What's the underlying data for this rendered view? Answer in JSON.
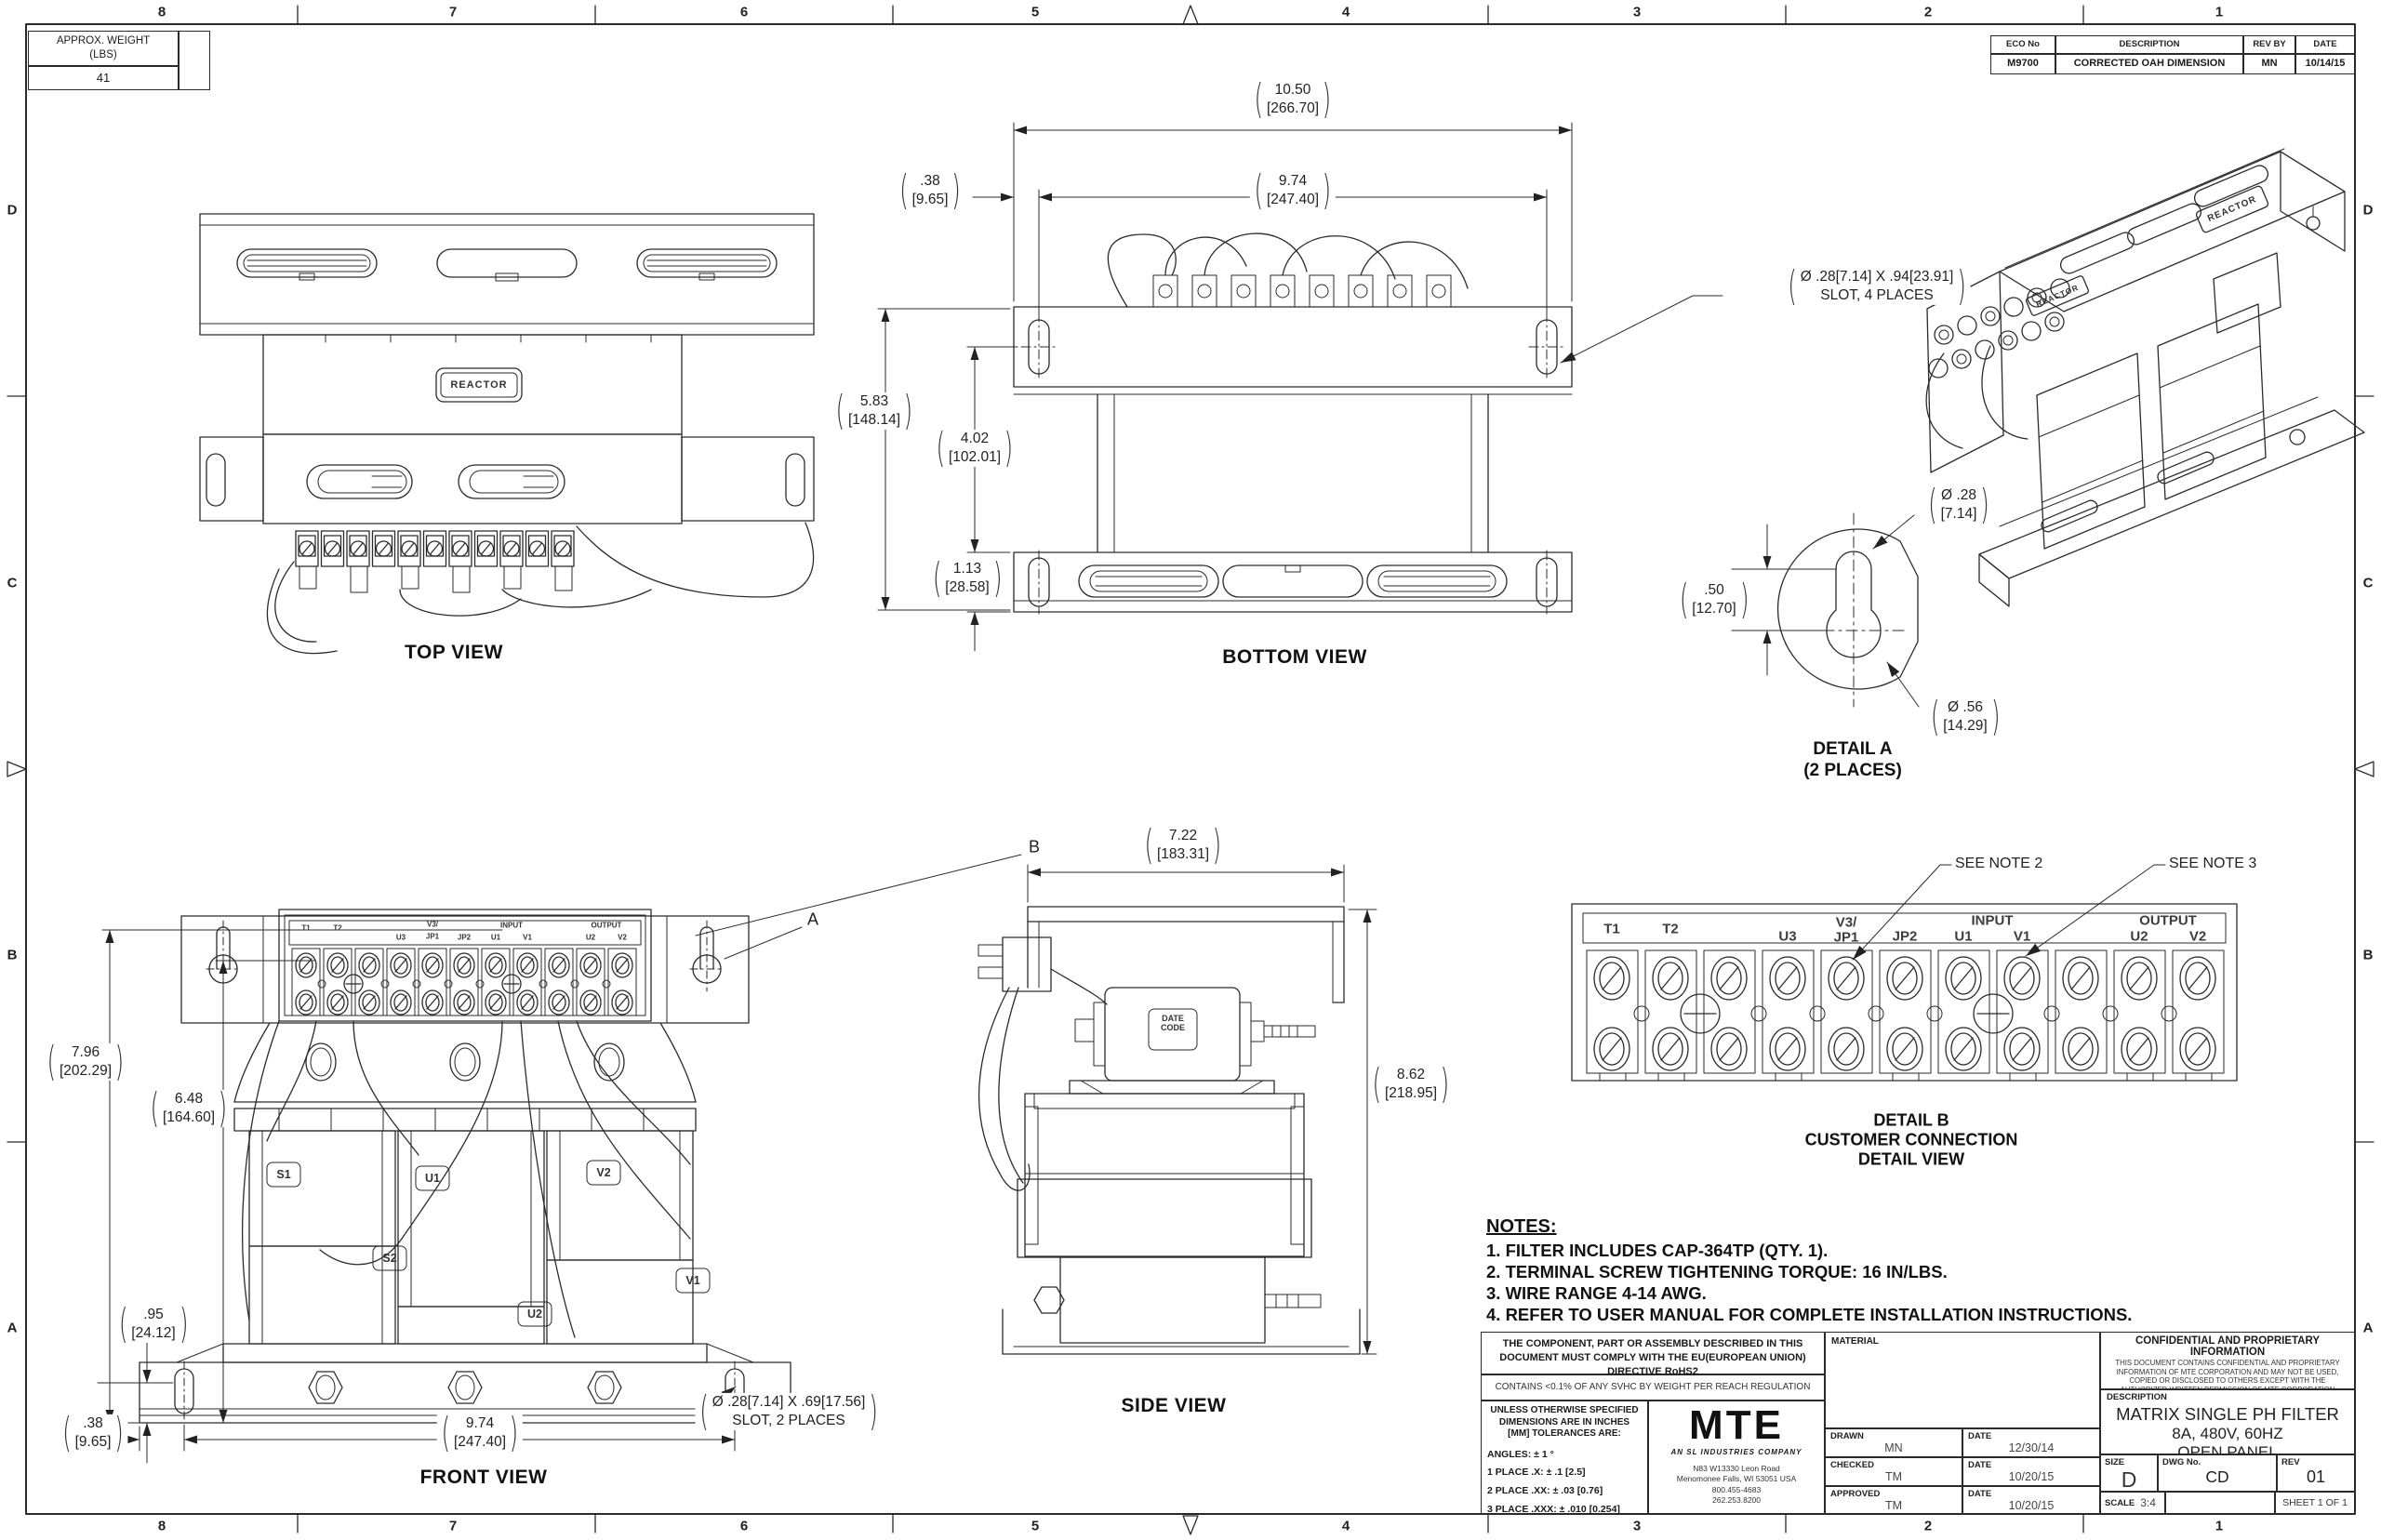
{
  "sheet": {
    "zones_top": [
      "8",
      "7",
      "6",
      "5",
      "4",
      "3",
      "2",
      "1"
    ],
    "zones_bottom": [
      "8",
      "7",
      "6",
      "5",
      "4",
      "3",
      "2",
      "1"
    ],
    "zones_side": [
      "D",
      "C",
      "B",
      "A"
    ]
  },
  "weight_box": {
    "title": "APPROX. WEIGHT",
    "unit": "(LBS)",
    "value": "41"
  },
  "eco": {
    "headers": [
      "ECO No",
      "DESCRIPTION",
      "REV BY",
      "DATE"
    ],
    "row": [
      "M9700",
      "CORRECTED OAH DIMENSION",
      "MN",
      "10/14/15"
    ]
  },
  "labels": {
    "top_view": "TOP VIEW",
    "bottom_view": "BOTTOM VIEW",
    "front_view": "FRONT VIEW",
    "side_view": "SIDE VIEW",
    "reactor": "REACTOR",
    "date_code_1": "DATE",
    "date_code_2": "CODE"
  },
  "detail_a": {
    "title": "DETAIL A",
    "qty": "(2 PLACES)"
  },
  "detail_b": {
    "title": "DETAIL B",
    "sub1": "CUSTOMER CONNECTION",
    "sub2": "DETAIL VIEW",
    "note2": "SEE NOTE 2",
    "note3": "SEE NOTE 3",
    "input": "INPUT",
    "output": "OUTPUT",
    "t": {
      "t1": "T1",
      "t2": "T2",
      "u3": "U3",
      "v3": "V3/",
      "jp1": "JP1",
      "jp2": "JP2",
      "u1": "U1",
      "v1": "V1",
      "u2": "U2",
      "v2": "V2"
    }
  },
  "coil_labels": {
    "s1": "S1",
    "s2": "S2",
    "u1": "U1",
    "u2": "U2",
    "v1": "V1",
    "v2": "V2"
  },
  "dims": {
    "d1050": {
      "v": "10.50",
      "mm": "[266.70]"
    },
    "d974": {
      "v": "9.74",
      "mm": "[247.40]"
    },
    "d038": {
      "v": ".38",
      "mm": "[9.65]"
    },
    "d583": {
      "v": "5.83",
      "mm": "[148.14]"
    },
    "d402": {
      "v": "4.02",
      "mm": "[102.01]"
    },
    "d113": {
      "v": "1.13",
      "mm": "[28.58]"
    },
    "d796": {
      "v": "7.96",
      "mm": "[202.29]"
    },
    "d648": {
      "v": "6.48",
      "mm": "[164.60]"
    },
    "d095": {
      "v": ".95",
      "mm": "[24.12]"
    },
    "d722": {
      "v": "7.22",
      "mm": "[183.31]"
    },
    "d862": {
      "v": "8.62",
      "mm": "[218.95]"
    },
    "d050": {
      "v": ".50",
      "mm": "[12.70]"
    },
    "dia28": {
      "v": "Ø .28",
      "mm": "[7.14]"
    },
    "dia56": {
      "v": "Ø .56",
      "mm": "[14.29]"
    }
  },
  "callouts": {
    "slot4_l1": "Ø .28[7.14] X .94[23.91]",
    "slot4_l2": "SLOT, 4 PLACES",
    "slot2_l1": "Ø .28[7.14] X .69[17.56]",
    "slot2_l2": "SLOT, 2 PLACES",
    "a": "A",
    "b": "B"
  },
  "notes": {
    "title": "NOTES:",
    "items": [
      "1.  FILTER INCLUDES CAP-364TP (QTY. 1).",
      "2.  TERMINAL SCREW TIGHTENING TORQUE: 16 IN/LBS.",
      "3.  WIRE RANGE 4-14 AWG.",
      "4.  REFER TO USER MANUAL FOR COMPLETE INSTALLATION INSTRUCTIONS."
    ]
  },
  "title_block": {
    "rohs": "THE COMPONENT, PART OR ASSEMBLY DESCRIBED IN THIS DOCUMENT MUST COMPLY WITH THE EU(EUROPEAN UNION) DIRECTIVE RoHS2",
    "reach": "CONTAINS <0.1% OF ANY SVHC BY WEIGHT PER REACH REGULATION",
    "tol_header": "UNLESS OTHERWISE SPECIFIED DIMENSIONS ARE IN INCHES [MM] TOLERANCES ARE:",
    "tol1": "ANGLES: ± 1 °",
    "tol2": "1 PLACE .X: ± .1 [2.5]",
    "tol3": "2 PLACE .XX: ± .03 [0.76]",
    "tol4": "3 PLACE .XXX: ± .010 [0.254]",
    "logo": "MTE",
    "logo_sub": "AN SL INDUSTRIES COMPANY",
    "addr1": "N83 W13330 Leon Road",
    "addr2": "Menomonee Falls, WI 53051 USA",
    "addr3": "800.455-4683",
    "addr4": "262.253.8200",
    "material_label": "MATERIAL",
    "drawn_label": "DRAWN",
    "drawn": "MN",
    "date_label": "DATE",
    "drawn_date": "12/30/14",
    "checked_label": "CHECKED",
    "checked": "TM",
    "checked_date": "10/20/15",
    "approved_label": "APPROVED",
    "approved": "TM",
    "approved_date": "10/20/15",
    "conf_title": "CONFIDENTIAL AND PROPRIETARY INFORMATION",
    "conf_body": "THIS DOCUMENT CONTAINS CONFIDENTIAL AND PROPRIETARY INFORMATION OF MTE CORPORATION AND MAY NOT BE USED, COPIED OR DISCLOSED TO OTHERS EXCEPT WITH THE AUTHORIZED WRITTEN PERMISSION OF MTE CORPORATION",
    "desc_label": "DESCRIPTION",
    "desc1": "MATRIX SINGLE PH FILTER",
    "desc2": "8A, 480V, 60HZ",
    "desc3": "OPEN PANEL",
    "size_label": "SIZE",
    "size": "D",
    "dwg_label": "DWG No.",
    "dwg": "CD MSP0008D",
    "rev_label": "REV",
    "rev": "01",
    "scale_label": "SCALE",
    "scale": "3:4",
    "sheet": "SHEET 1  OF 1"
  }
}
